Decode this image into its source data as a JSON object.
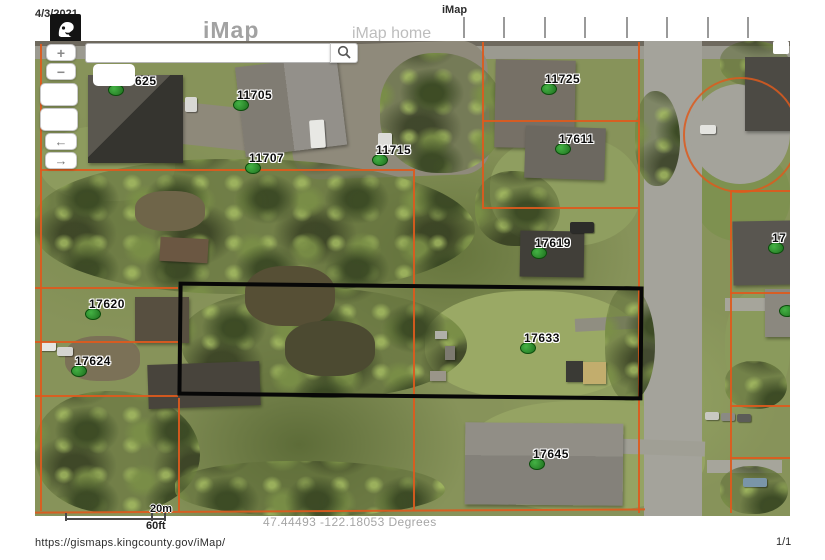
{
  "print_header": {
    "date": "4/3/2021",
    "page_title": "iMap"
  },
  "print_footer": {
    "url": "https://gismaps.kingcounty.gov/iMap/",
    "page_number": "1/1"
  },
  "app_header": {
    "app_title": "iMap",
    "home_link": "iMap home",
    "logo": "king-county-logo"
  },
  "search": {
    "value": "",
    "placeholder": "",
    "icon": "search-icon"
  },
  "controls": {
    "zoom_in": "+",
    "zoom_out": "−",
    "pan_left": "←",
    "pan_right": "→"
  },
  "map": {
    "type": "aerial-imagery",
    "coordinate_readout": "47.44493 -122.18053 Degrees",
    "scale_metric": "20m",
    "scale_imperial": "60ft",
    "colors": {
      "parcel_line": "#dd5a1d",
      "selection_outline": "#000000",
      "marker_green": "#2e8b2e",
      "header_gray": "#a2a2a2"
    },
    "parcel_labels": [
      {
        "label": "625",
        "x": 80,
        "y": 48,
        "lx": 20,
        "ly": -15
      },
      {
        "label": "11705",
        "x": 205,
        "y": 63
      },
      {
        "label": "11707",
        "x": 217,
        "y": 126
      },
      {
        "label": "11715",
        "x": 344,
        "y": 118
      },
      {
        "label": "11725",
        "x": 513,
        "y": 47
      },
      {
        "label": "17611",
        "x": 527,
        "y": 107
      },
      {
        "label": "17619",
        "x": 503,
        "y": 211
      },
      {
        "label": "17620",
        "x": 57,
        "y": 272
      },
      {
        "label": "17624",
        "x": 43,
        "y": 329
      },
      {
        "label": "17633",
        "x": 492,
        "y": 306
      },
      {
        "label": "17645",
        "x": 501,
        "y": 422
      },
      {
        "label": "17",
        "x": 740,
        "y": 206
      },
      {
        "label": "",
        "x": 751,
        "y": 269
      }
    ]
  }
}
